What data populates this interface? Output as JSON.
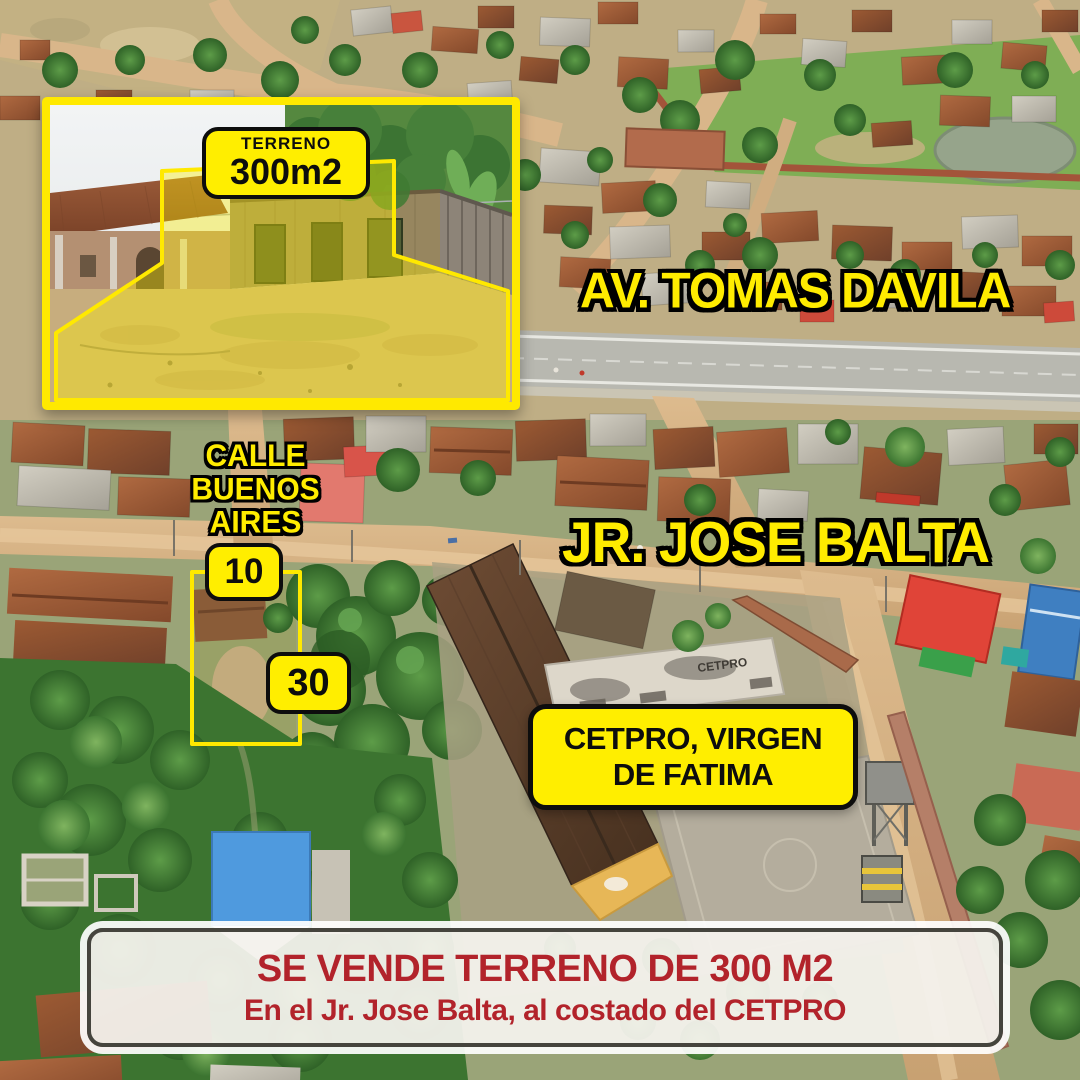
{
  "ad": {
    "inset": {
      "label_top": "TERRENO",
      "label_size": "300m2"
    },
    "streets": {
      "avenue": "AV. TOMAS DAVILA",
      "calle_line1": "CALLE BUENOS",
      "calle_line2": "AIRES",
      "jiron": "JR. JOSE BALTA"
    },
    "lot": {
      "front_m": "10",
      "depth_m": "30"
    },
    "poi": {
      "line1": "CETPRO, VIRGEN",
      "line2": "DE FATIMA",
      "building_sign": "CETPRO"
    },
    "banner": {
      "title": "SE VENDE TERRENO DE 300 M2",
      "subtitle": "En el Jr. Jose Balta, al costado del CETPRO"
    },
    "colors": {
      "accent_yellow": "#ffee00",
      "label_text_black": "#0d0d0d",
      "banner_red": "#b2232b",
      "banner_bg": "#f4f2ed",
      "banner_border": "#45443d",
      "dirt_road": "#d9b487",
      "vegetation": "#3c7430"
    }
  }
}
